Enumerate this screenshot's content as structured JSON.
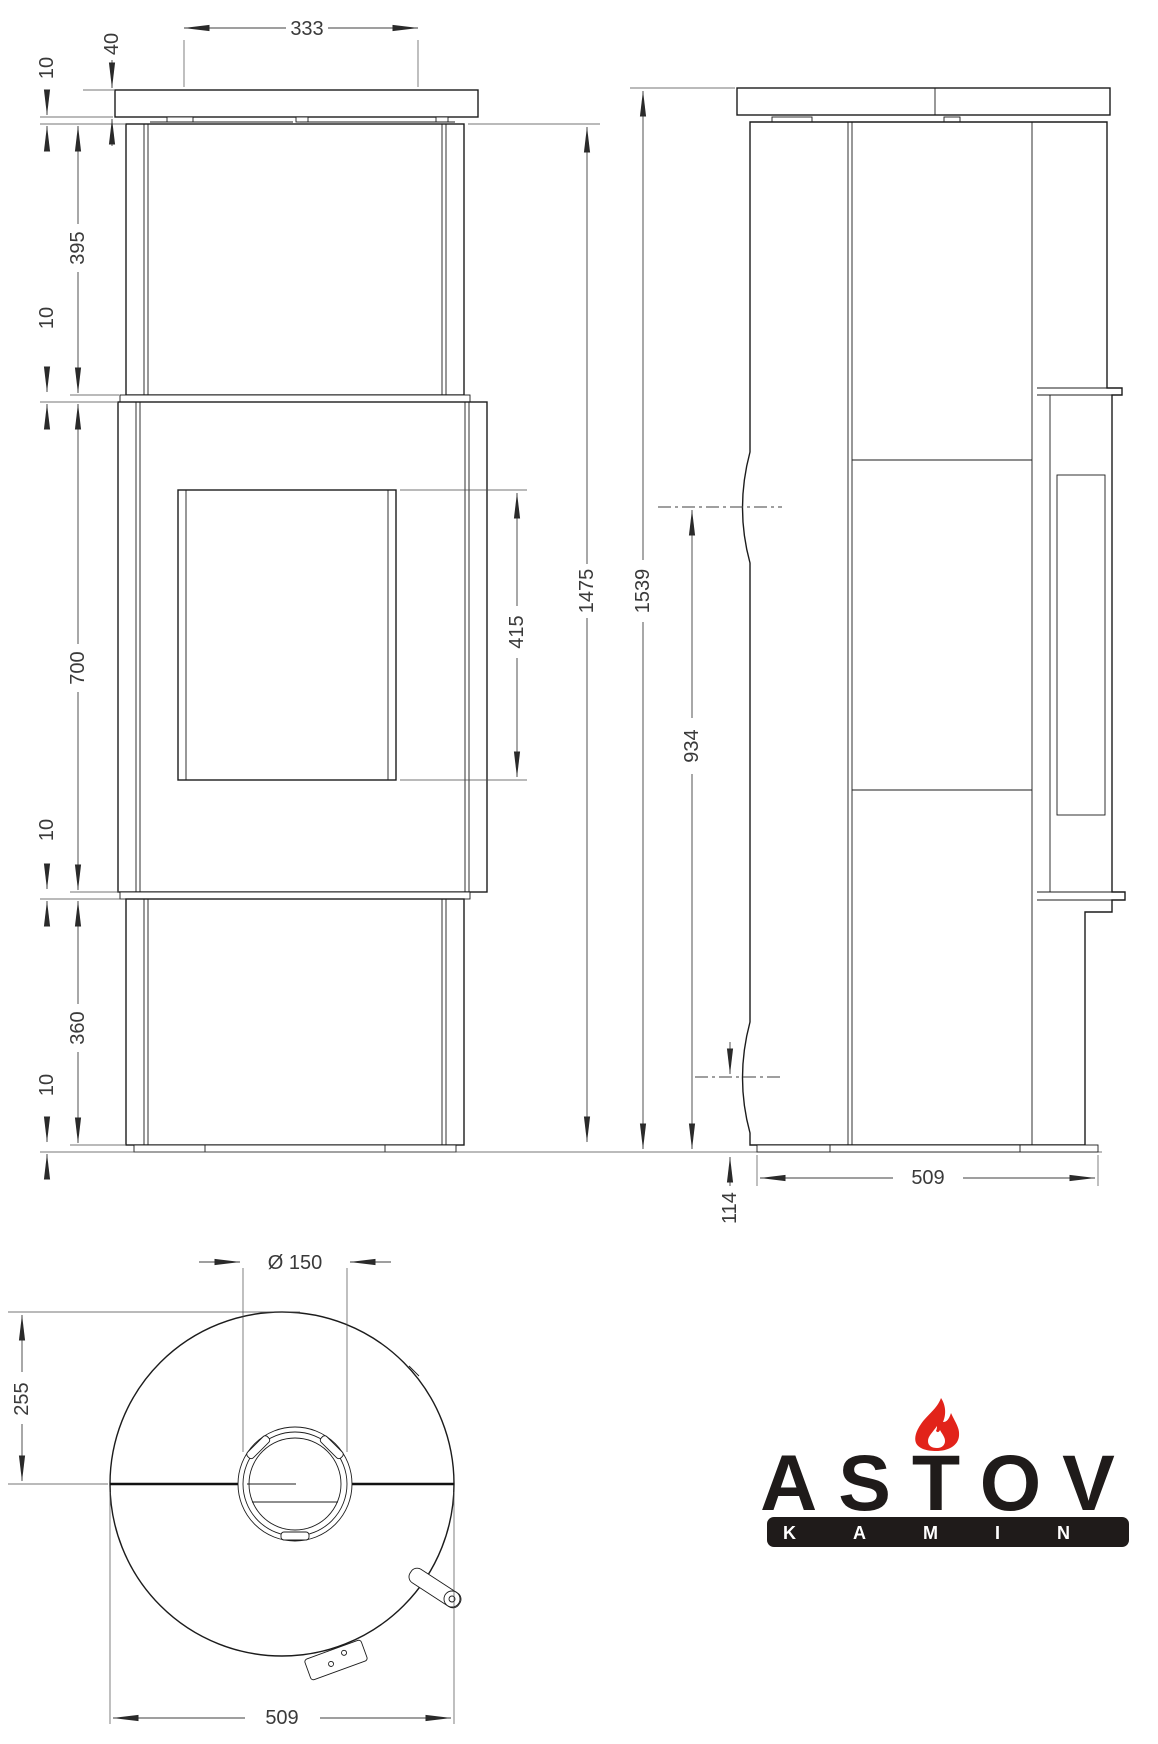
{
  "front_view": {
    "dim_top_width": "333",
    "dim_plate_thickness": "40",
    "dim_gap_plate": "10",
    "dim_section_top": "395",
    "dim_gap_upper": "10",
    "dim_section_middle": "700",
    "dim_gap_lower": "10",
    "dim_section_bottom": "360",
    "dim_base": "10",
    "dim_glass_height": "415",
    "dim_body_height": "1475"
  },
  "side_view": {
    "dim_total_height": "1539",
    "dim_flue_center_height": "934",
    "dim_lower_outlet_height": "114",
    "dim_depth": "509"
  },
  "top_view": {
    "dim_flue_diameter": "Ø 150",
    "dim_rear_offset": "255",
    "dim_width": "509"
  },
  "logo": {
    "brand": "ASTOV",
    "subtitle": "KAMIN",
    "flame_color": "#e2231a",
    "text_color": "#1f1b1a"
  }
}
